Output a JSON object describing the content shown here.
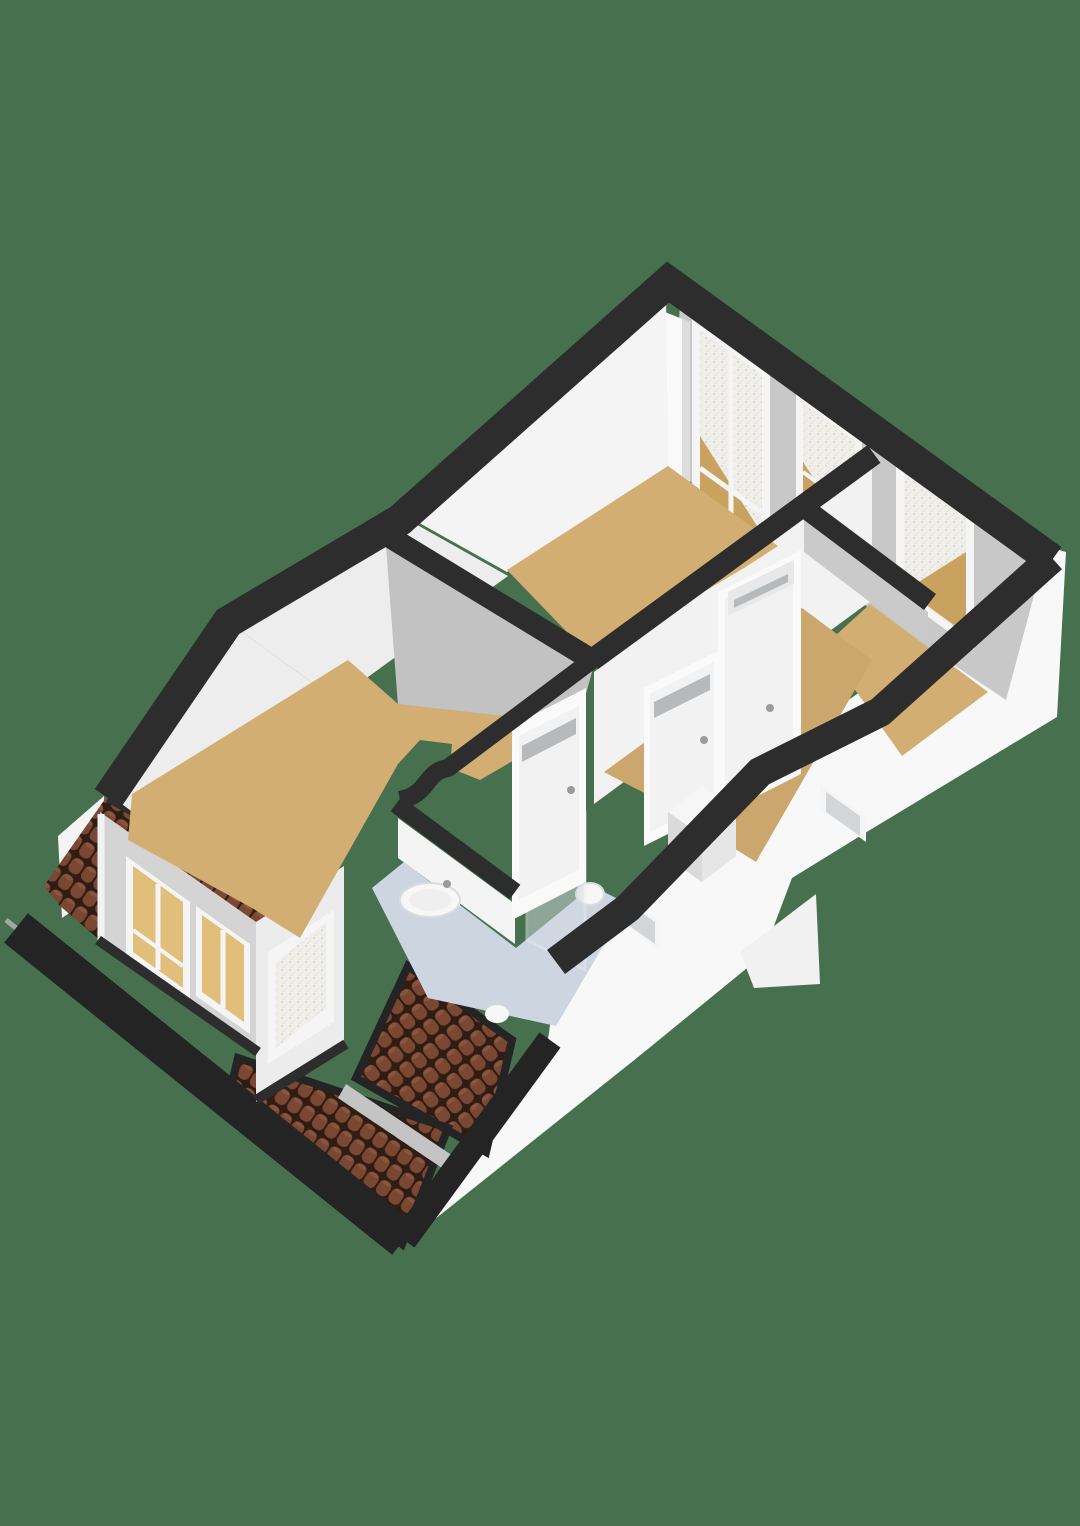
{
  "image": {
    "width": 1080,
    "height": 1526,
    "kind": "3d-floorplan-render",
    "view": "isometric-top"
  },
  "palette": {
    "background": "#47704E",
    "band": "#2D2D2D",
    "fascia": "#242424",
    "gutter": "#A3A6A3",
    "facade": "#F8F8F8",
    "facade_shadow": "#F1F1F1",
    "wall_white": "#F4F4F4",
    "wall_white_dim": "#EDEDED",
    "wall_face_light": "#F2F2F2",
    "wall_gray": "#C8C8C8",
    "wall_gray_mid": "#C2C2C2",
    "wall_gray_small": "#CACACA",
    "dormer_front": "#D4D4D4",
    "dormer_cheek": "#ECECEC",
    "pilaster": "#FAFAFA",
    "pilaster_edge": "#DDDDDD",
    "floor_wood": "#D3AE73",
    "floor_wood_dim": "#CCA76D",
    "floor_bath": "#CCD5E0",
    "tile": "#7A4733",
    "tile_gap": "#2F1C12",
    "tile_hi": "#8A553F",
    "beam_gray": "#C4C4C4",
    "window_frame": "#F5F5F5",
    "glass": "#EFEEE9",
    "glass_speck_a": "#D6D6CE",
    "glass_speck_b": "#DFDFD8",
    "glass_wedge_tan": "#C9A25F",
    "dormer_pane_tan": "#E2BE7B",
    "facade_glass": "#D3D6D8",
    "door_leaf": "#F2F2F2",
    "door_frame": "#FAFAFA",
    "door_vent": "#B6BABD",
    "door_vent_frame": "#E8E8E8",
    "handle": "#9B9B9B",
    "fixture": "#F7F7F7",
    "fixture_line": "#DCDCDC",
    "fixture_inner": "#EFEFEF",
    "shower_glass": "#D4DAE0",
    "shower_edge": "#EAEDF0",
    "stairs_top": "#F6F6F6",
    "stairs_side_e": "#E6E6E6",
    "stairs_side_w": "#DADADA"
  },
  "scene": {
    "building": "upper-floor cutaway with tiled roof and dormer",
    "rooms": [
      {
        "name": "bedroom-top",
        "floor": "wood"
      },
      {
        "name": "bedroom-left",
        "floor": "wood"
      },
      {
        "name": "bedroom-right",
        "floor": "wood"
      },
      {
        "name": "landing",
        "floor": "wood"
      },
      {
        "name": "bathroom",
        "floor": "blue-tile"
      }
    ],
    "counts": {
      "interior_doors": 3,
      "wall_windows": 3,
      "dormer_windows": 3,
      "facade_windows": 2,
      "roof_tile_patches": 3
    },
    "fixtures": [
      "washbasin",
      "toilet",
      "shower-screen",
      "stair-bulkhead"
    ]
  }
}
